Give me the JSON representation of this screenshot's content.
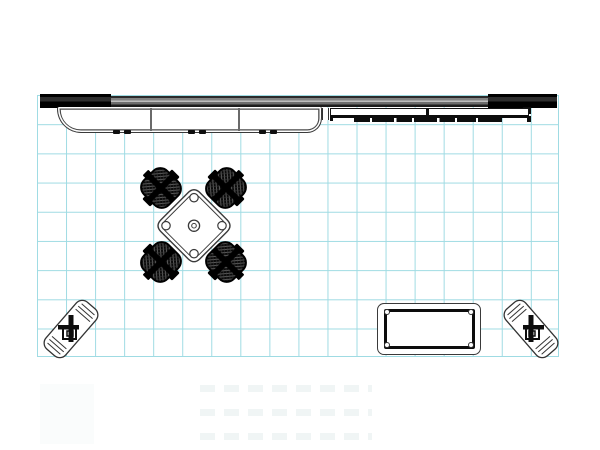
{
  "meta": {
    "type": "technical-floor-plan",
    "description": "Top view plan drawing of a trade show exhibit booth on a cyan grid",
    "visible_text": "none"
  },
  "colors": {
    "background": "#ffffff",
    "grid_line": "#9fdbe3",
    "outline": "#3a3a3a",
    "solid_black": "#0d0d0d",
    "backwall_gray": "#828282"
  },
  "grid": {
    "columns": 18,
    "rows": 9,
    "cell_px": 29
  },
  "items": {
    "backwall": {
      "label": "backwall beam with dark end caps",
      "count": 1
    },
    "counter": {
      "label": "long reception counter with rounded left end, 2 dividers, 3 leg pairs",
      "count": 1
    },
    "shelf": {
      "label": "two-bay wall shelf",
      "count": 1
    },
    "graphic_strip": {
      "label": "narrow segmented strip",
      "count": 1
    },
    "conference_table": {
      "label": "square conference table rotated 45 degrees with corner discs",
      "count": 1
    },
    "chairs": {
      "label": "mesh office chair",
      "count": 4
    },
    "coffee_table": {
      "label": "rectangular coffee table with corner fasteners",
      "count": 1
    },
    "folding_stools": {
      "label": "folded stool/cart at 45 degrees",
      "count": 2
    }
  }
}
